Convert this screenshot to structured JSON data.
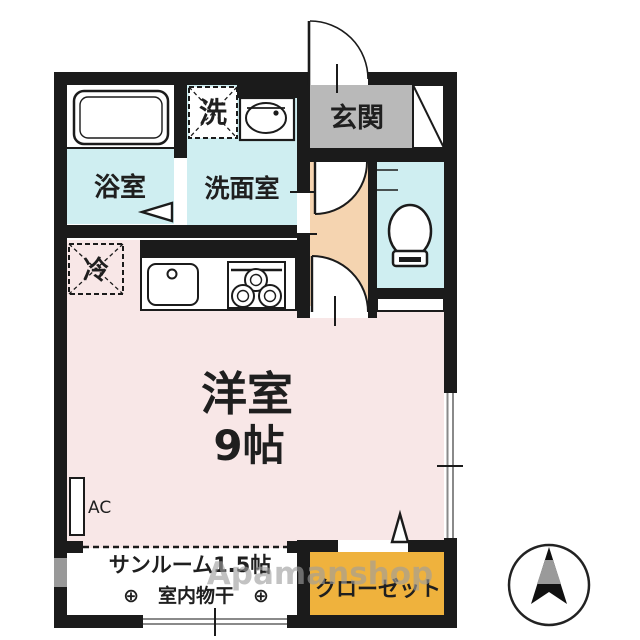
{
  "plan_title": "1K apartment floor plan",
  "colors": {
    "wall": "#1b1b1b",
    "wet_room_blue": "#cfeef1",
    "main_room_pink": "#f8e7e7",
    "hallway_peach": "#f5d4b0",
    "entrance_gray": "#b9b9b9",
    "closet_orange": "#efb23d",
    "window_gray": "#999999",
    "watermark_gray": "#9e9e9e"
  },
  "rooms": {
    "bathroom": {
      "label": "浴室"
    },
    "washroom": {
      "label": "洗面室"
    },
    "washer_box": {
      "label": "洗"
    },
    "fridge_box": {
      "label": "冷"
    },
    "entrance": {
      "label": "玄関"
    },
    "main_room": {
      "label": "洋室",
      "size": "9帖"
    },
    "sunroom": {
      "label": "サンルーム1.5帖",
      "note": "⊕　室内物干　⊕"
    },
    "closet": {
      "label": "クローゼット"
    },
    "ac_unit": {
      "label": "AC"
    }
  },
  "icons": {
    "bathtub": "bathtub-icon",
    "washbasin": "washbasin-icon",
    "toilet": "toilet-icon",
    "kitchen_sink": "kitchen-sink-icon",
    "stove": "stove-icon",
    "laundry_hook_symbol": "⊕",
    "compass": "compass-north-icon"
  },
  "watermark": "Apamanshop",
  "compass": {
    "direction": "N"
  }
}
